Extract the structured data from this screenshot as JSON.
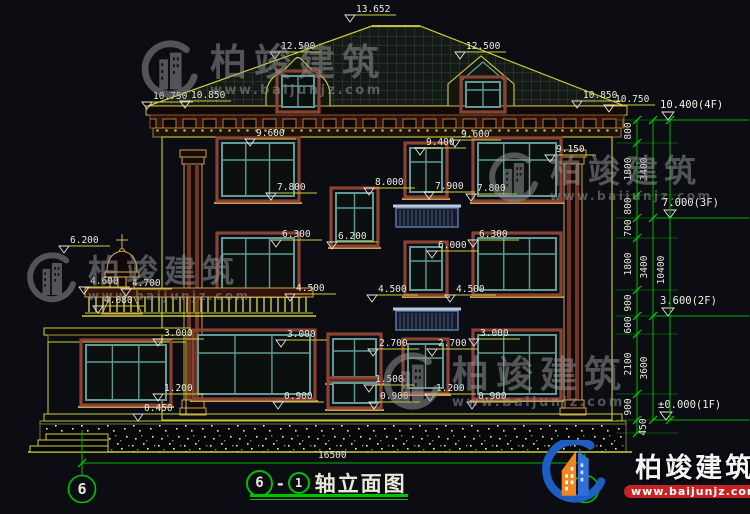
{
  "title": {
    "bubble_left": "6",
    "sep": "-",
    "bubble_right": "1",
    "text": "轴立面图"
  },
  "watermark": {
    "brand": "柏竣建筑",
    "url": "www.baijunjz.com"
  },
  "logo": {
    "brand": "柏竣建筑",
    "url": "www.baijunjz.com"
  },
  "colors": {
    "accent_green": "#00b400",
    "dim_yellow": "#cfcf3a",
    "text": "#e9e9da",
    "window_teal": "#5f9a96",
    "surround_brown": "#8a4232",
    "trim_tan": "#c8a050",
    "rail_blue": "#5878a8",
    "logo_blue": "#1e5ec4",
    "logo_orange": "#f08522",
    "logo_red": "#c62222",
    "watermark_gray": "#9b9b9b"
  },
  "drawing": {
    "labels": [
      {
        "t": "13.652",
        "x": 356,
        "y": 12
      },
      {
        "t": "12.500",
        "x": 281,
        "y": 49
      },
      {
        "t": "12.500",
        "x": 466,
        "y": 49
      },
      {
        "t": "10.750",
        "x": 153,
        "y": 99
      },
      {
        "t": "10.850",
        "x": 191,
        "y": 98
      },
      {
        "t": "10.850",
        "x": 583,
        "y": 98
      },
      {
        "t": "10.750",
        "x": 615,
        "y": 102
      },
      {
        "t": "9.150",
        "x": 556,
        "y": 152
      },
      {
        "t": "9.600",
        "x": 256,
        "y": 136
      },
      {
        "t": "9.400",
        "x": 426,
        "y": 145
      },
      {
        "t": "9.600",
        "x": 461,
        "y": 137
      },
      {
        "t": "8.000",
        "x": 375,
        "y": 185
      },
      {
        "t": "7.900",
        "x": 435,
        "y": 189
      },
      {
        "t": "7.800",
        "x": 277,
        "y": 190
      },
      {
        "t": "7.800",
        "x": 477,
        "y": 191
      },
      {
        "t": "6.200",
        "x": 70,
        "y": 243
      },
      {
        "t": "6.300",
        "x": 282,
        "y": 237
      },
      {
        "t": "6.200",
        "x": 338,
        "y": 239
      },
      {
        "t": "6.000",
        "x": 438,
        "y": 248
      },
      {
        "t": "6.300",
        "x": 479,
        "y": 237
      },
      {
        "t": "4.600",
        "x": 90,
        "y": 284
      },
      {
        "t": "4.700",
        "x": 132,
        "y": 286
      },
      {
        "t": "4.080",
        "x": 104,
        "y": 303
      },
      {
        "t": "4.500",
        "x": 296,
        "y": 291
      },
      {
        "t": "4.500",
        "x": 378,
        "y": 292
      },
      {
        "t": "4.500",
        "x": 456,
        "y": 292
      },
      {
        "t": "3.000",
        "x": 164,
        "y": 336
      },
      {
        "t": "3.000",
        "x": 287,
        "y": 337
      },
      {
        "t": "3.000",
        "x": 480,
        "y": 336
      },
      {
        "t": "2.700",
        "x": 379,
        "y": 346
      },
      {
        "t": "2.700",
        "x": 438,
        "y": 346
      },
      {
        "t": "1.500",
        "x": 375,
        "y": 382
      },
      {
        "t": "1.200",
        "x": 164,
        "y": 391
      },
      {
        "t": "1.200",
        "x": 436,
        "y": 391
      },
      {
        "t": "0.900",
        "x": 284,
        "y": 399
      },
      {
        "t": "0.900",
        "x": 380,
        "y": 399
      },
      {
        "t": "0.900",
        "x": 478,
        "y": 399
      },
      {
        "t": "0.450",
        "x": 144,
        "y": 411
      },
      {
        "t": "16500",
        "x": 318,
        "y": 458,
        "plain": true
      }
    ],
    "level_markers": [
      {
        "t": "10.400(4F)",
        "x": 660,
        "textY": 108,
        "lineY": 120
      },
      {
        "t": "7.000(3F)",
        "x": 662,
        "textY": 206,
        "lineY": 218
      },
      {
        "t": "3.600(2F)",
        "x": 660,
        "textY": 304,
        "lineY": 316
      },
      {
        "t": "±0.000(1F)",
        "x": 658,
        "textY": 408,
        "lineY": 420
      }
    ],
    "dim_chain": {
      "cols": [
        {
          "x": 637,
          "y1": 120,
          "y2": 433,
          "bounds": [
            120,
            143,
            195,
            218,
            238,
            290,
            316,
            334,
            394,
            420,
            433
          ],
          "labels": [
            {
              "t": "800",
              "y": 131
            },
            {
              "t": "1800",
              "y": 169
            },
            {
              "t": "800",
              "y": 206
            },
            {
              "t": "700",
              "y": 228
            },
            {
              "t": "1800",
              "y": 264
            },
            {
              "t": "900",
              "y": 303
            },
            {
              "t": "600",
              "y": 325
            },
            {
              "t": "2100",
              "y": 364
            },
            {
              "t": "900",
              "y": 407
            },
            {
              "t": "450",
              "y": 427,
              "x": 646
            }
          ]
        },
        {
          "x": 653,
          "y1": 120,
          "y2": 420,
          "bounds": [
            120,
            218,
            316,
            420
          ],
          "labels": [
            {
              "t": "3400",
              "y": 169
            },
            {
              "t": "3400",
              "y": 267
            },
            {
              "t": "3600",
              "y": 368
            }
          ]
        },
        {
          "x": 670,
          "y1": 120,
          "y2": 420,
          "bounds": [
            120,
            420
          ],
          "labels": [
            {
              "t": "10400",
              "y": 270
            }
          ]
        }
      ],
      "extension_ys": [
        120,
        143,
        195,
        218,
        238,
        290,
        316,
        334,
        394,
        420,
        433
      ]
    },
    "axis": {
      "dim_y": 463,
      "x1": 82,
      "x2": 585,
      "bubbles": [
        {
          "n": "6",
          "cx": 82
        },
        {
          "n": "1",
          "cx": 585
        }
      ]
    }
  },
  "geometry": {
    "windows": [
      {
        "x": 222,
        "y": 143,
        "w": 72,
        "h": 53,
        "t": 17,
        "m": [
          0.33,
          0.66
        ]
      },
      {
        "x": 410,
        "y": 148,
        "w": 32,
        "h": 44,
        "t": 14,
        "m": [
          0.5
        ]
      },
      {
        "x": 478,
        "y": 143,
        "w": 78,
        "h": 53,
        "t": 17,
        "m": [
          0.33,
          0.66
        ]
      },
      {
        "x": 336,
        "y": 193,
        "w": 37,
        "h": 48,
        "t": 15,
        "m": [
          0.5
        ]
      },
      {
        "x": 222,
        "y": 238,
        "w": 72,
        "h": 52,
        "t": 16,
        "m": [
          0.33,
          0.66
        ]
      },
      {
        "x": 410,
        "y": 247,
        "w": 32,
        "h": 43,
        "t": 14,
        "m": [
          0.5
        ]
      },
      {
        "x": 478,
        "y": 238,
        "w": 78,
        "h": 52,
        "t": 16,
        "m": [
          0.33,
          0.66
        ]
      },
      {
        "x": 198,
        "y": 335,
        "w": 112,
        "h": 59,
        "t": 18,
        "m": [
          0.33,
          0.66
        ]
      },
      {
        "x": 333,
        "y": 339,
        "w": 43,
        "h": 38,
        "t": 12,
        "m": [
          0.5
        ]
      },
      {
        "x": 333,
        "y": 383,
        "w": 43,
        "h": 20,
        "t": 0,
        "m": [
          0.5
        ]
      },
      {
        "x": 408,
        "y": 344,
        "w": 35,
        "h": 44,
        "t": 14,
        "m": [
          0.5
        ]
      },
      {
        "x": 478,
        "y": 335,
        "w": 78,
        "h": 59,
        "t": 18,
        "m": [
          0.33,
          0.66
        ]
      },
      {
        "x": 86,
        "y": 345,
        "w": 80,
        "h": 55,
        "t": 17,
        "m": [
          0.33,
          0.66
        ]
      },
      {
        "x": 282,
        "y": 76,
        "w": 32,
        "h": 31,
        "t": 10,
        "m": [
          0.5
        ],
        "s": false
      },
      {
        "x": 466,
        "y": 82,
        "w": 34,
        "h": 25,
        "t": 8,
        "m": [
          0.5
        ],
        "s": false
      }
    ],
    "railings": [
      {
        "x": 396,
        "y": 204,
        "w": 62,
        "h": 23
      },
      {
        "x": 396,
        "y": 307,
        "w": 62,
        "h": 23
      }
    ],
    "balustrade": {
      "x": 85,
      "y": 288,
      "w": 228,
      "h": 28
    }
  }
}
